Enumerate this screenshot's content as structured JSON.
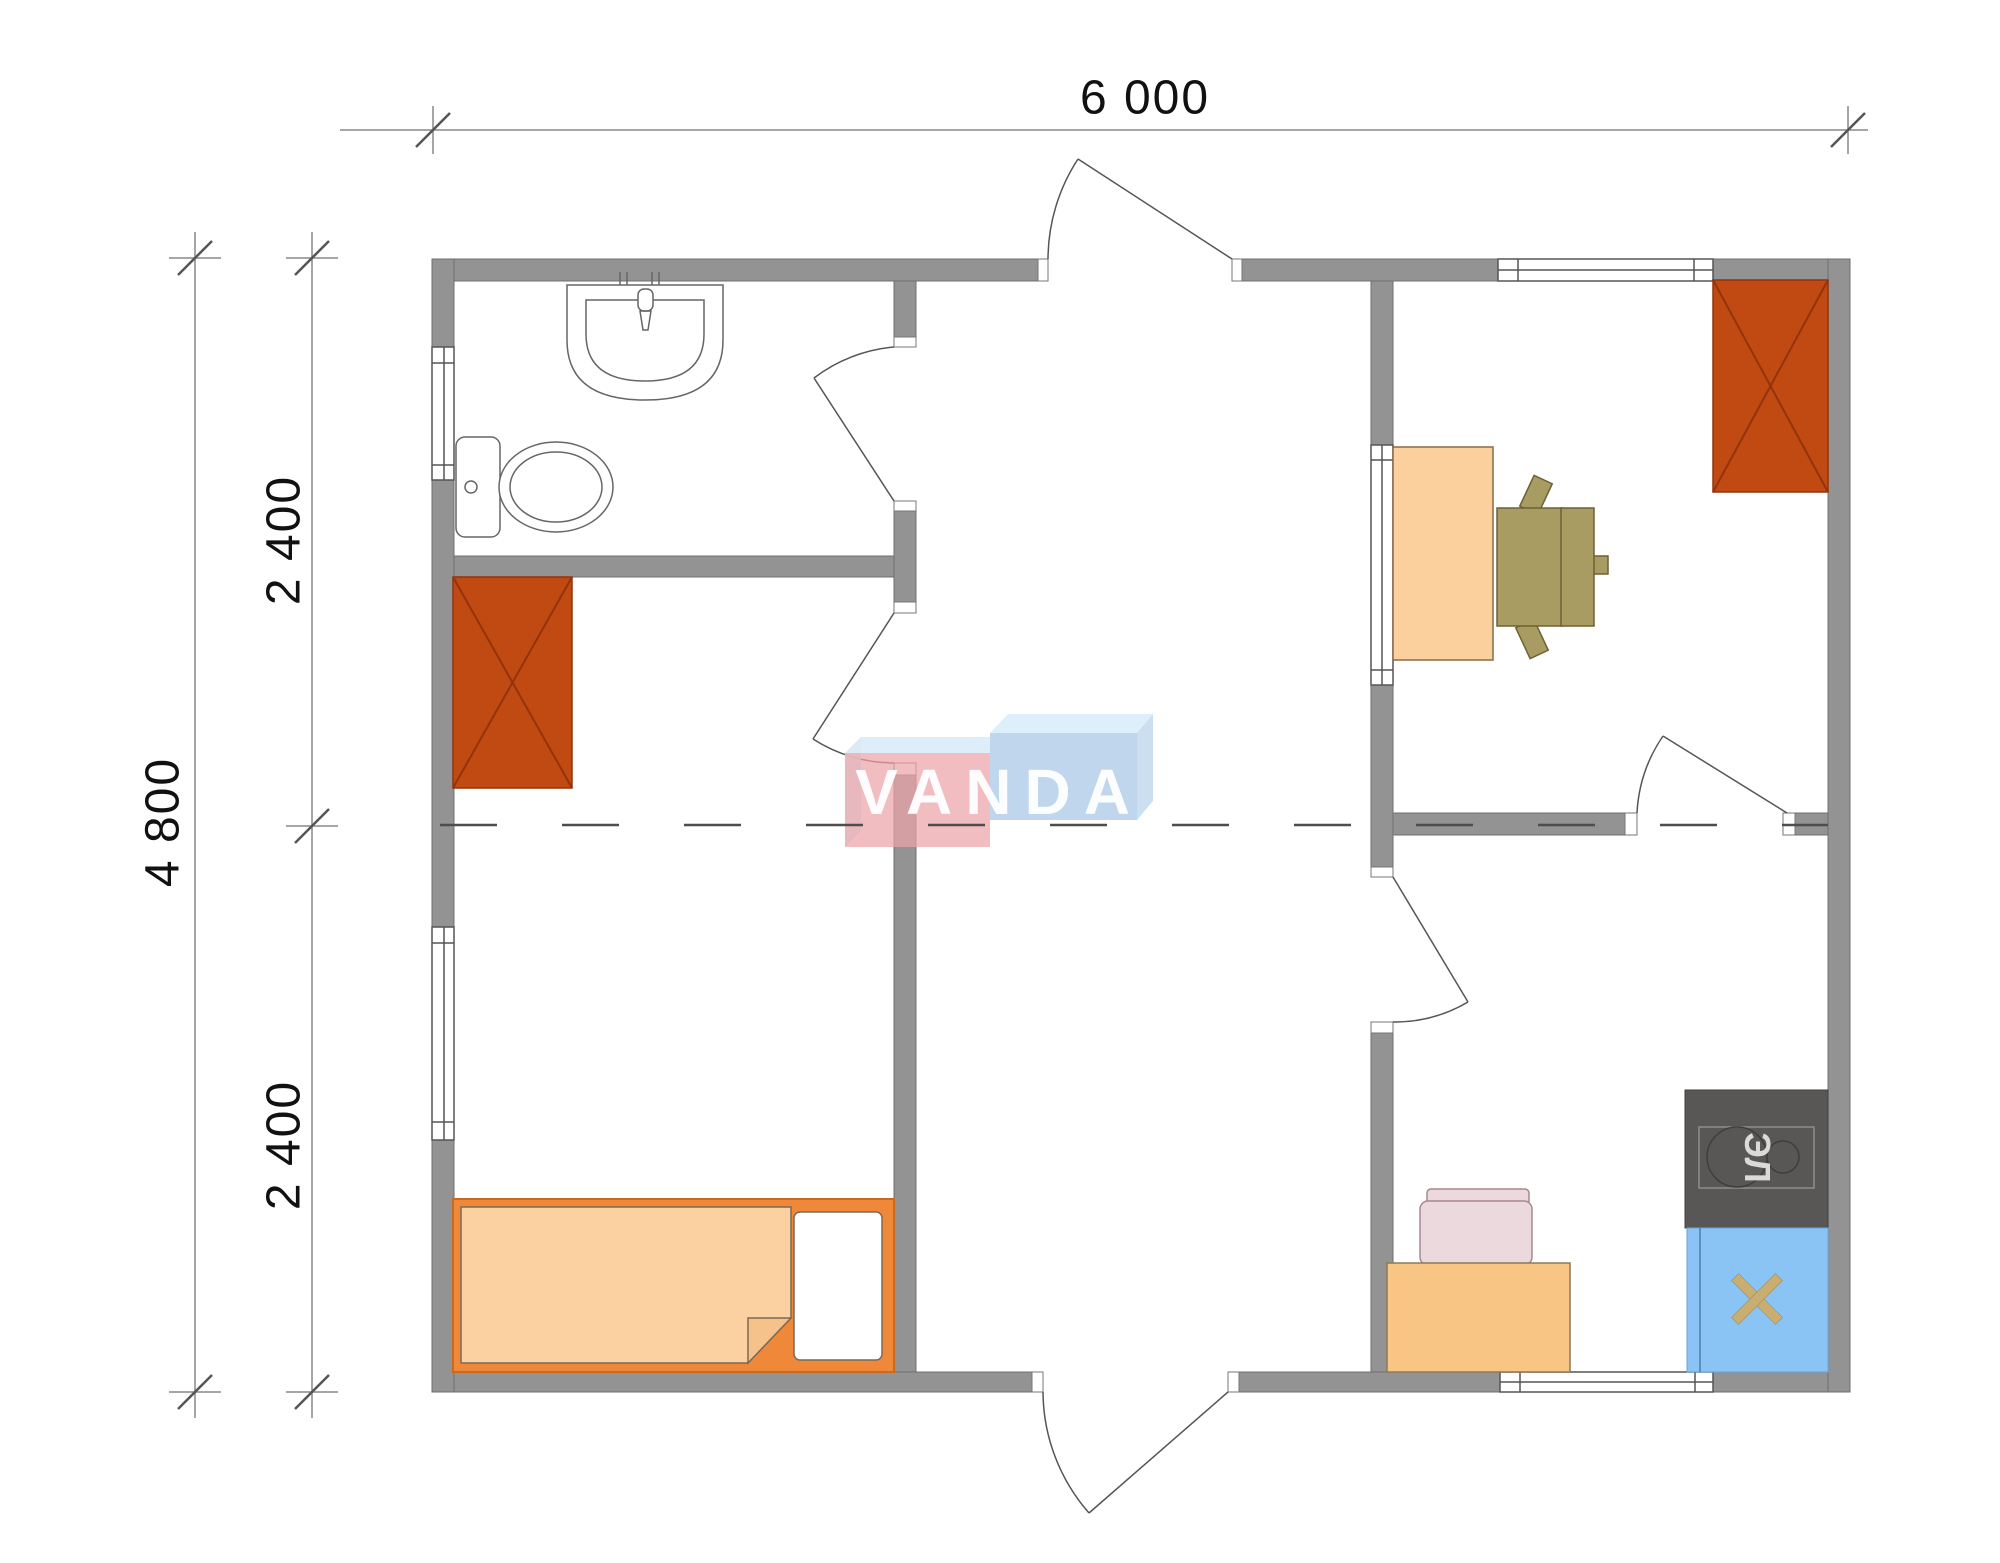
{
  "dimensions": {
    "width": "6 000",
    "height_total": "4 800",
    "height_upper": "2 400",
    "height_lower": "2 400"
  },
  "watermark": {
    "text": "VANDA",
    "pink_box_color": "#f0adb2",
    "blue_box_color": "#b7d1ea",
    "top_face_color": "#d9edfa",
    "text_color": "#ffffff"
  },
  "kitchen": {
    "stove_label": "ЭЛ"
  },
  "icons": [
    "toilet-icon",
    "washbasin-icon",
    "wardrobe-x-icon",
    "bed-icon",
    "pillow-icon",
    "desk-icon",
    "office-chair-icon",
    "kitchen-table-icon",
    "kitchen-chair-icon",
    "electric-stove-icon",
    "kitchen-sink-icon",
    "door-swing-icon",
    "window-icon"
  ],
  "colors": {
    "wall": "#939393",
    "fixture_red": "#c04a12",
    "bed_frame": "#f0883a",
    "mattress": "#fbd1a1",
    "pillow": "#ffffff",
    "desk": "#fcd09d",
    "office_chair": "#a89c63",
    "kitchen_table": "#f9c584",
    "kitchen_chair": "#ecd9dd",
    "stove": "#595755",
    "sink": "#8ac4f4",
    "dimension_line": "#888888"
  }
}
